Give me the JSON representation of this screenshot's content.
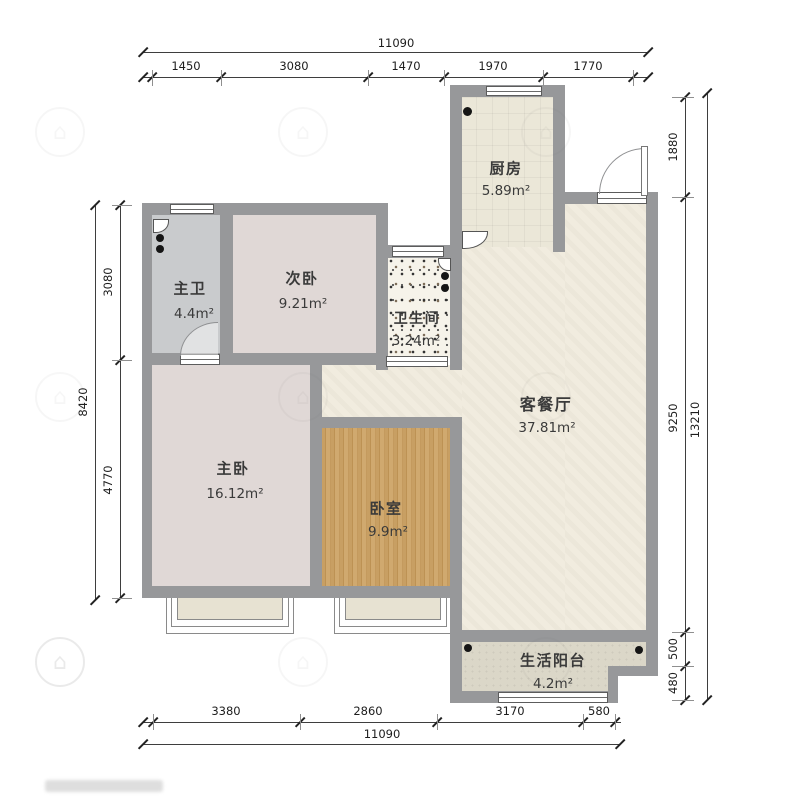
{
  "plan": {
    "type": "apartment-floor-plan",
    "wall_color": "#97989a",
    "wood_floor_color": "#c49a5e",
    "living_floor_color": "#f1ecdf",
    "bedroom_floor_color": "#e0d8d6",
    "bath_floor_color": "#c9cbcd"
  },
  "rooms": {
    "kitchen": {
      "name": "厨房",
      "area": "5.89m²"
    },
    "master_bath": {
      "name": "主卫",
      "area": "4.4m²"
    },
    "second_bedroom": {
      "name": "次卧",
      "area": "9.21m²"
    },
    "bathroom": {
      "name": "卫生间",
      "area": "3.24m²"
    },
    "living_dining": {
      "name": "客餐厅",
      "area": "37.81m²"
    },
    "master_bedroom": {
      "name": "主卧",
      "area": "16.12m²"
    },
    "bedroom": {
      "name": "卧室",
      "area": "9.9m²"
    },
    "balcony": {
      "name": "生活阳台",
      "area": "4.2m²"
    }
  },
  "dimensions": {
    "top": {
      "total": "11090",
      "segments": [
        "1450",
        "3080",
        "1470",
        "1970",
        "1770"
      ]
    },
    "bottom": {
      "total": "11090",
      "segments": [
        "3380",
        "2860",
        "3170",
        "580"
      ]
    },
    "left": {
      "total": "8420",
      "segments": [
        "3080",
        "4770"
      ]
    },
    "right": {
      "total": "13210",
      "segments": [
        "1880",
        "9250",
        "500",
        "480"
      ]
    }
  }
}
